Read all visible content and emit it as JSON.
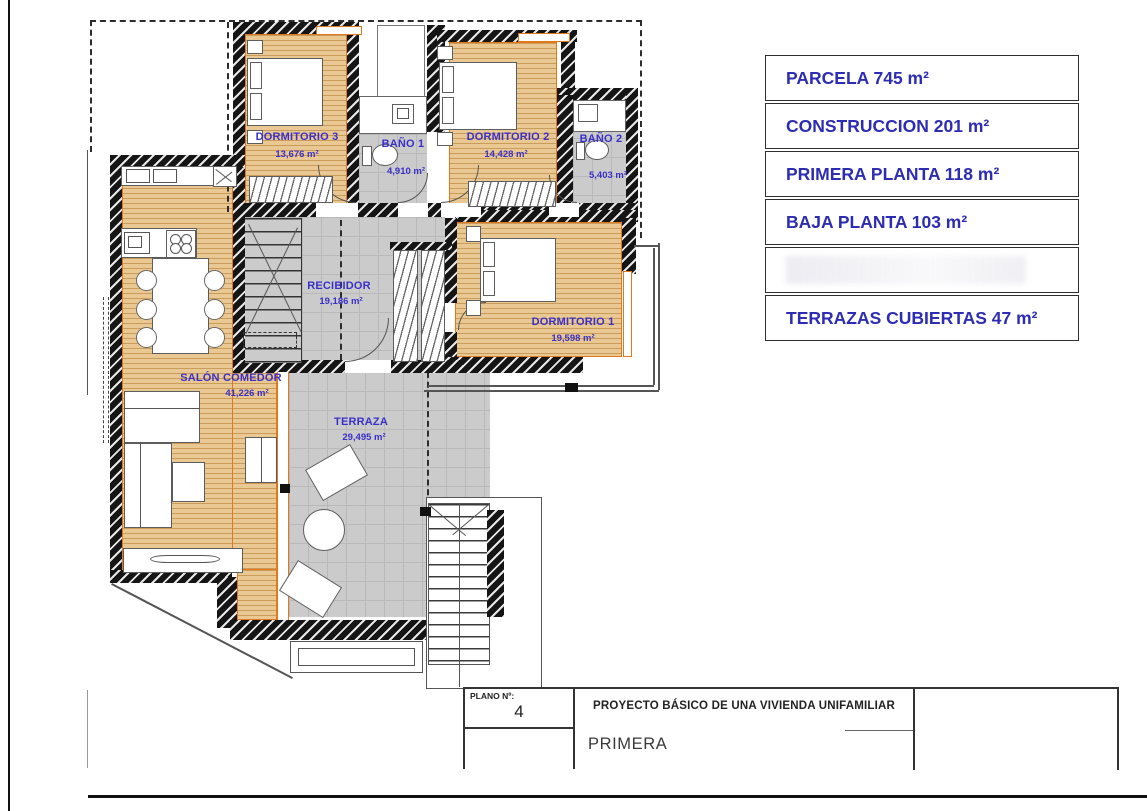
{
  "plan": {
    "rooms": [
      {
        "name": "DORMITORIO 3",
        "area": "13,676 m²"
      },
      {
        "name": "BAÑO 1",
        "area": "4,910 m²"
      },
      {
        "name": "DORMITORIO 2",
        "area": "14,428 m²"
      },
      {
        "name": "BAÑO 2",
        "area": "5,403 m²"
      },
      {
        "name": "RECIBIDOR",
        "area": "19,186 m²"
      },
      {
        "name": "DORMITORIO 1",
        "area": "19,598 m²"
      },
      {
        "name": "SALÓN COMEDOR",
        "area": "41,226 m²"
      },
      {
        "name": "TERRAZA",
        "area": "29,495 m²"
      }
    ]
  },
  "area_table": {
    "rows": [
      {
        "label": "PARCELA 745 m²"
      },
      {
        "label": "CONSTRUCCION 201 m²"
      },
      {
        "label": "PRIMERA PLANTA 118 m²"
      },
      {
        "label": "BAJA PLANTA 103 m²"
      },
      {
        "label": ""
      },
      {
        "label": "TERRAZAS CUBIERTAS 47 m²"
      }
    ]
  },
  "title_block": {
    "plano_label": "PLANO Nº:",
    "plano_number": "4",
    "project_title": "PROYECTO BÁSICO DE UNA VIVIENDA UNIFAMILIAR",
    "sheet_name": "PRIMERA"
  },
  "colors": {
    "room_label_blue": "#3a30c8",
    "table_text_blue": "#2c2cb4",
    "wood_floor": "#eac893",
    "tile_gray": "#cbcbcb",
    "wall_black": "#151515",
    "window_orange": "#e2771c"
  }
}
